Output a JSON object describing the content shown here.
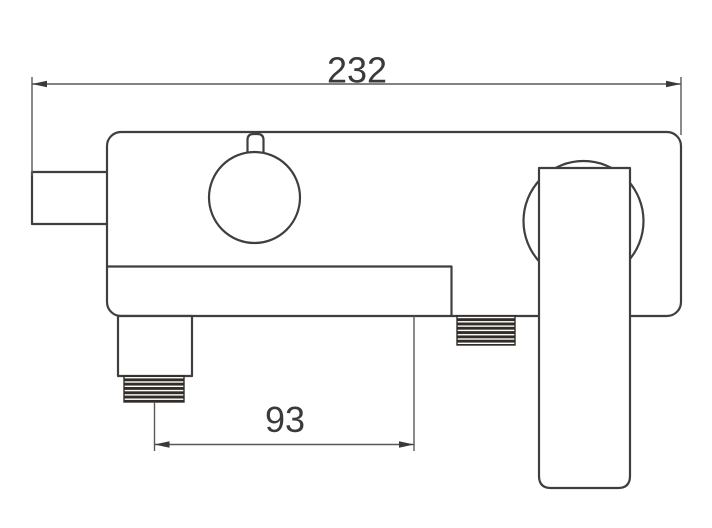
{
  "dimensions": {
    "overall_width": "232",
    "spout_offset": "93"
  },
  "colors": {
    "background": "#ffffff",
    "part-line": "#3f3f3f",
    "dim-line": "#585858",
    "dim-text": "#3a3a3a",
    "thread-fill": "#332d28",
    "thread-gap": "#ffffff"
  }
}
